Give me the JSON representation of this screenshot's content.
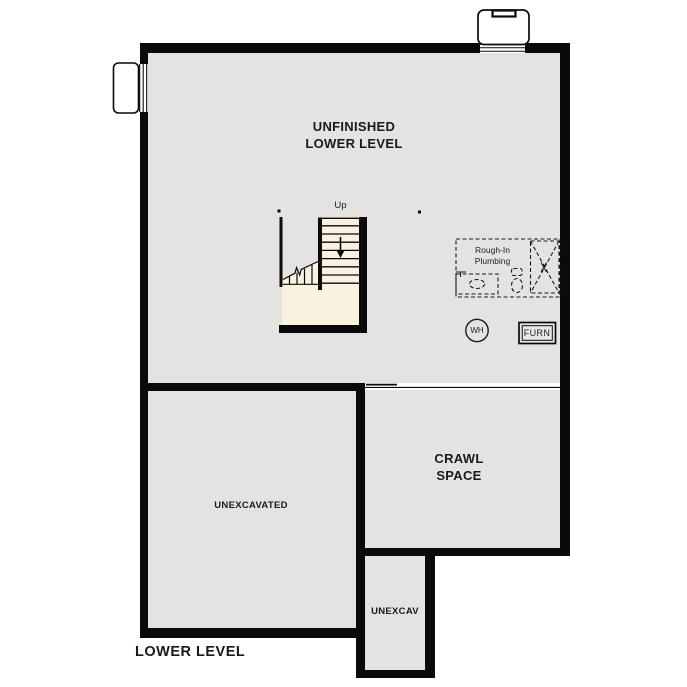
{
  "plan": {
    "title": "LOWER LEVEL",
    "rooms": {
      "main": "UNFINISHED\nLOWER LEVEL",
      "crawl": "CRAWL\nSPACE",
      "unexcavated": "UNEXCAVATED",
      "unexcav_strip": "UNEXCAV"
    },
    "labels": {
      "stair_direction": "Up",
      "plumbing": "Rough-In\nPlumbing",
      "water_heater": "WH",
      "furnace": "FURN"
    },
    "colors": {
      "floor": "#e4e3e1",
      "stairs": "#f9f2e1",
      "wall": "#0a0a0a",
      "background": "#ffffff"
    }
  }
}
